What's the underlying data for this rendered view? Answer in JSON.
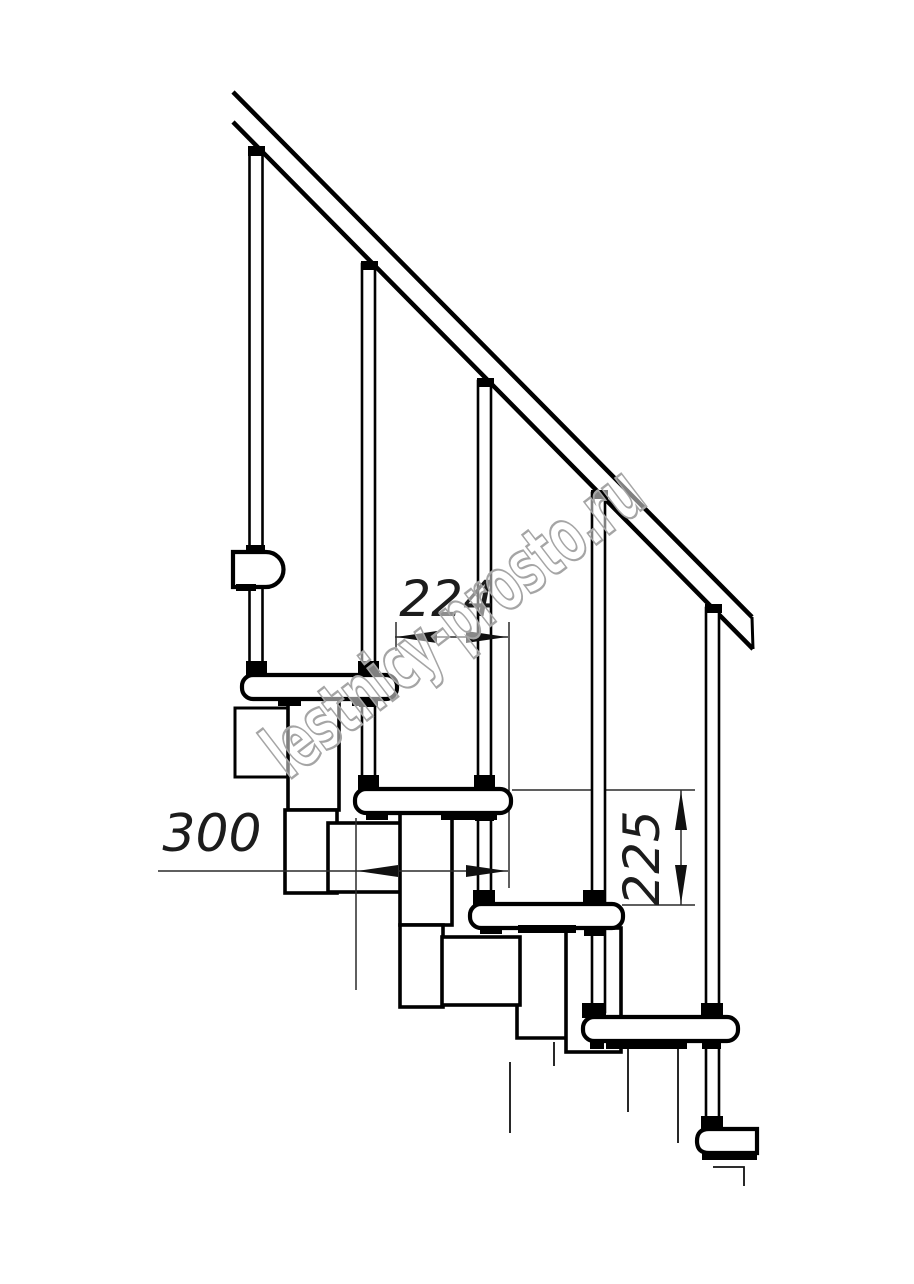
{
  "page": {
    "background": "#ffffff"
  },
  "drawing": {
    "kind": "modular-staircase-side-view",
    "line_color": "#000000",
    "dimension_text_color": "#1c1c1c",
    "dimensions": {
      "step_run": "224",
      "tread_depth": "300",
      "step_rise": "225"
    },
    "watermark": {
      "text": "lestnicy-prosto.ru",
      "outline_color": "#a5a5a5"
    },
    "counts": {
      "treads": 5,
      "balusters": 5
    }
  }
}
